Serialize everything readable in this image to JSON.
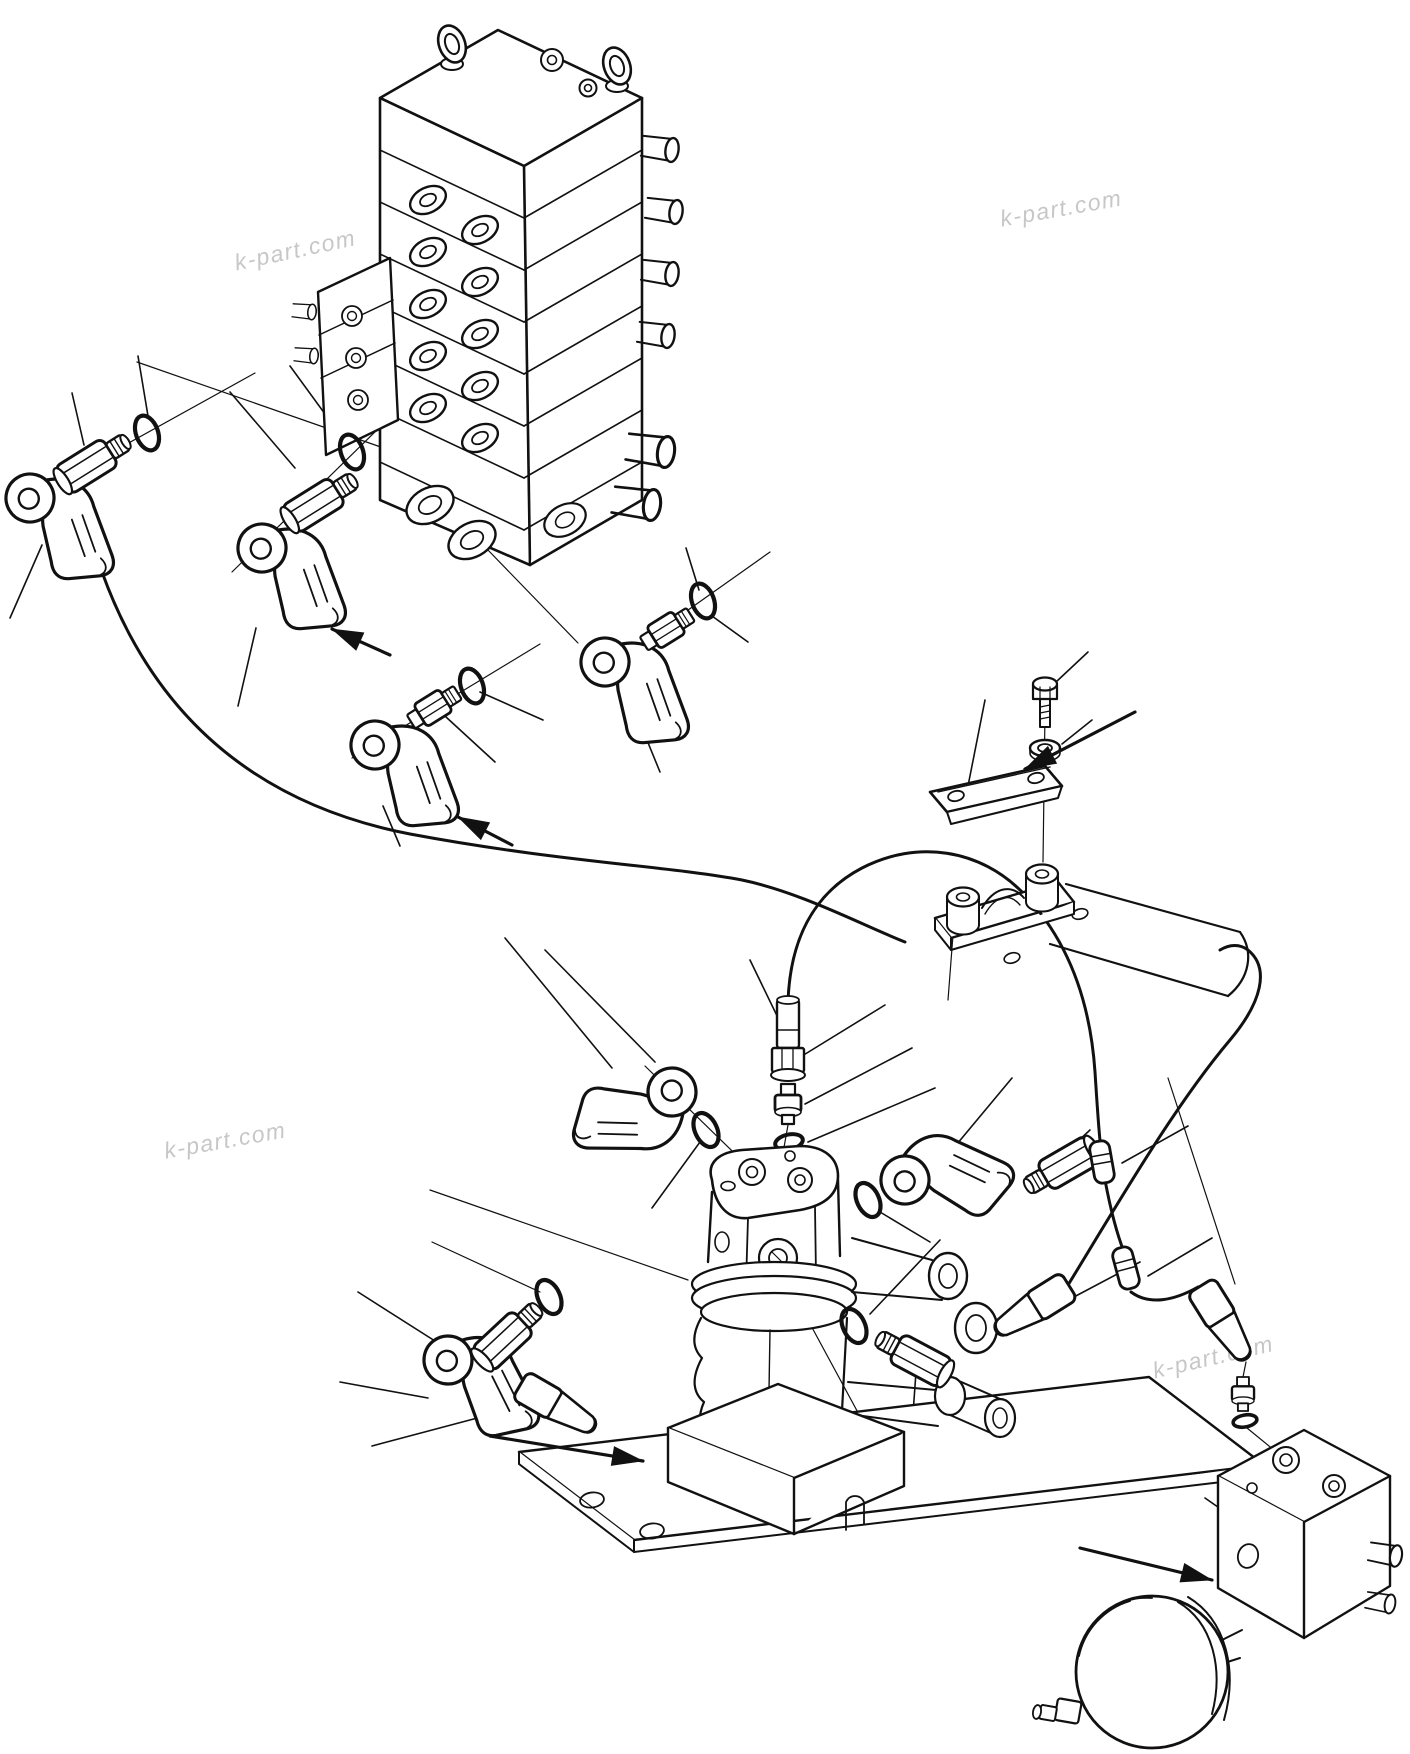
{
  "page": {
    "width": 1410,
    "height": 1754,
    "background_color": "#ffffff",
    "line_color": "#111111",
    "watermark_color": "#c7c7c7"
  },
  "watermark": {
    "text": "k-part.com"
  },
  "diagram": {
    "kind": "exploded-parts-line-drawing",
    "parts": [
      {
        "name": "control-valve-assembly"
      },
      {
        "name": "elbow-hose-fitting"
      },
      {
        "name": "adapter-fitting"
      },
      {
        "name": "union-fitting"
      },
      {
        "name": "o-ring"
      },
      {
        "name": "hose"
      },
      {
        "name": "hose-coupler"
      },
      {
        "name": "clamp-plate"
      },
      {
        "name": "mounting-bolt"
      },
      {
        "name": "washer"
      },
      {
        "name": "hose-bracket"
      },
      {
        "name": "swivel-joint"
      },
      {
        "name": "base-plate"
      },
      {
        "name": "accumulator-valve-block"
      },
      {
        "name": "accumulator"
      }
    ]
  }
}
